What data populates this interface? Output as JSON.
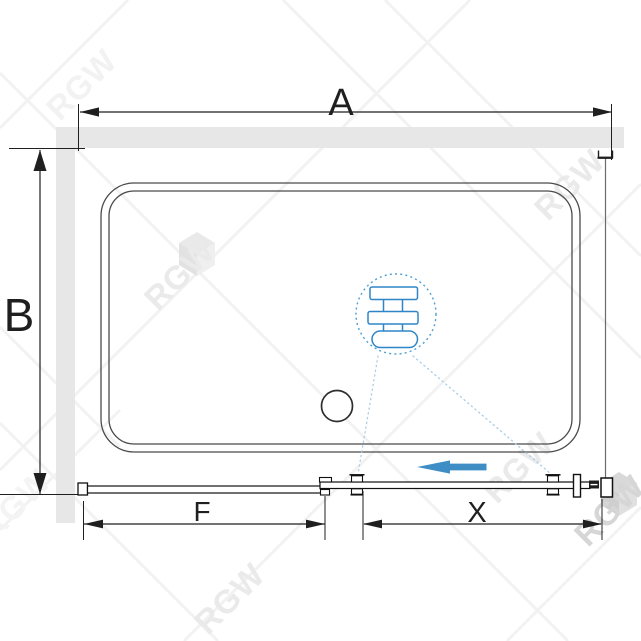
{
  "watermark": {
    "text": "RGW"
  },
  "diagram": {
    "dimension_labels": {
      "width": "A",
      "depth": "B",
      "fixed_panel": "F",
      "door": "X"
    },
    "colors": {
      "accent_blue": "#3E8EC5",
      "detail_blue": "#2E86C8",
      "dash_circle_blue": "#4E9FD4",
      "leader_blue": "#A9CDE5",
      "wall_fill": "#E7E7E7",
      "line": "#1F1F1F",
      "tray_line": "#4A4A4A",
      "watermark_gray": "#EAEAEA"
    },
    "icons": {
      "slide_direction": "left-arrow",
      "detail_view": "dashed-circle-magnifier",
      "drain": "circle"
    }
  }
}
